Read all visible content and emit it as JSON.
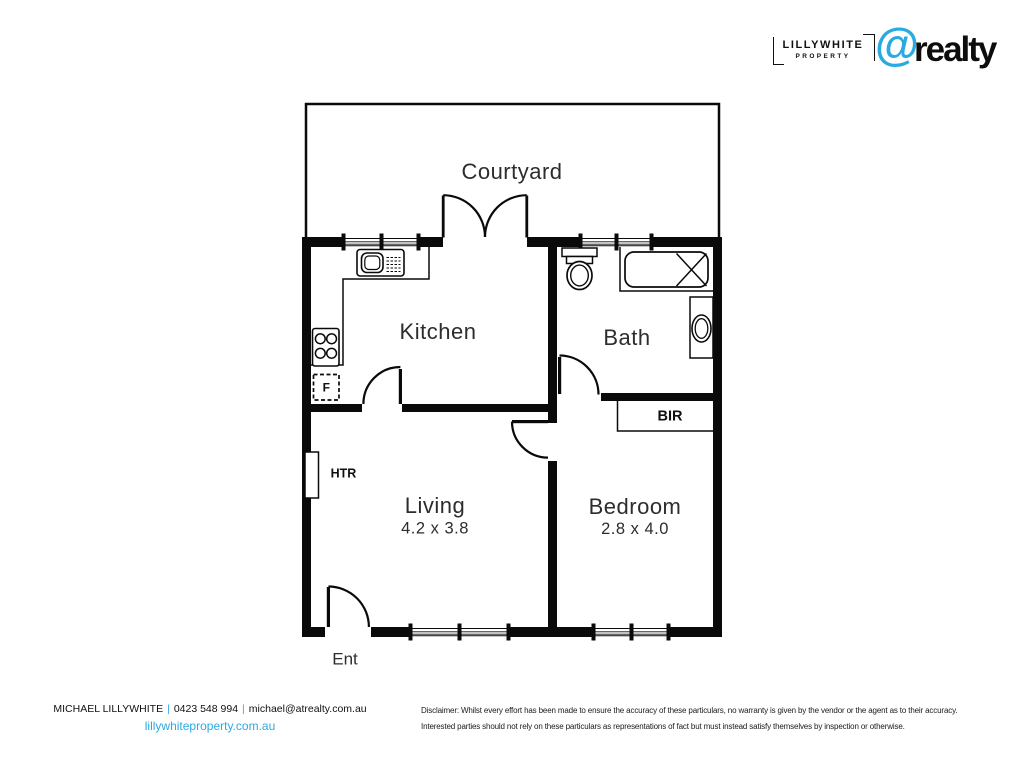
{
  "header": {
    "lillywhite": {
      "name": "LILLYWHITE",
      "tagline": "PROPERTY"
    },
    "atrealty": {
      "at_symbol": "@",
      "name": "realty"
    }
  },
  "floorplan": {
    "courtyard_label": "Courtyard",
    "kitchen_label": "Kitchen",
    "bath_label": "Bath",
    "living_label": "Living",
    "living_dimensions": "4.2 x 3.8",
    "bedroom_label": "Bedroom",
    "bedroom_dimensions": "2.8 x 4.0",
    "entry_label": "Ent",
    "heater_label": "HTR",
    "robe_label": "BIR",
    "fridge_label": "F"
  },
  "footer": {
    "agent_name": "MICHAEL LILLYWHITE",
    "separator": "|",
    "phone": "0423 548 994",
    "email": "michael@atrealty.com.au",
    "website": "lillywhiteproperty.com.au",
    "disclaimer_line1": "Disclaimer: Whilst every effort has been made to ensure the accuracy of these particulars, no warranty is given by the vendor or the agent as to their accuracy.",
    "disclaimer_line2": "Interested parties should not rely on these particulars as representations of fact but must instead satisfy themselves by inspection or otherwise."
  },
  "colors": {
    "brand_blue": "#29ABE2",
    "wall": "#0a0a0a",
    "label_text": "#2d2d2d"
  }
}
